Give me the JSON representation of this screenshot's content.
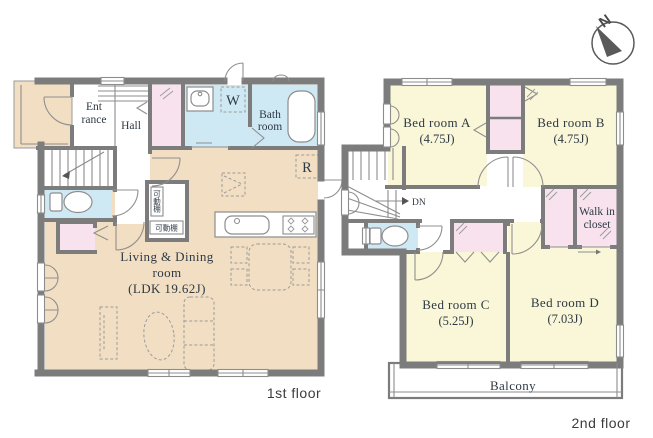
{
  "palette": {
    "wall_gray": "#7c7c7c",
    "ldk_floor_beige": "#f2dfc3",
    "bedroom_floor_yellow": "#faf7d8",
    "wet_room_blue": "#cee9f4",
    "closet_pink": "#f7e2ee",
    "label_text": "#2e3944"
  },
  "compass": {
    "north_label": "N"
  },
  "first_floor": {
    "caption": "1st floor",
    "labels": {
      "entrance_line1": "Ent",
      "entrance_line2": "rance",
      "hall": "Hall",
      "washing_machine": "W",
      "bath_line1": "Bath",
      "bath_line2": "room",
      "refrigerator": "R",
      "shelf_upper": "可動棚",
      "shelf_lower": "可動棚",
      "ldk_line1": "Living & Dining",
      "ldk_line2": "room",
      "ldk_line3": "(LDK 19.62J)"
    }
  },
  "second_floor": {
    "caption": "2nd floor",
    "labels": {
      "down": "DN",
      "bedroom_a_line1": "Bed room A",
      "bedroom_a_line2": "(4.75J)",
      "bedroom_b_line1": "Bed room B",
      "bedroom_b_line2": "(4.75J)",
      "bedroom_c_line1": "Bed room C",
      "bedroom_c_line2": "(5.25J)",
      "bedroom_d_line1": "Bed room D",
      "bedroom_d_line2": "(7.03J)",
      "walk_in_line1": "Walk in",
      "walk_in_line2": "closet",
      "balcony": "Balcony"
    }
  }
}
